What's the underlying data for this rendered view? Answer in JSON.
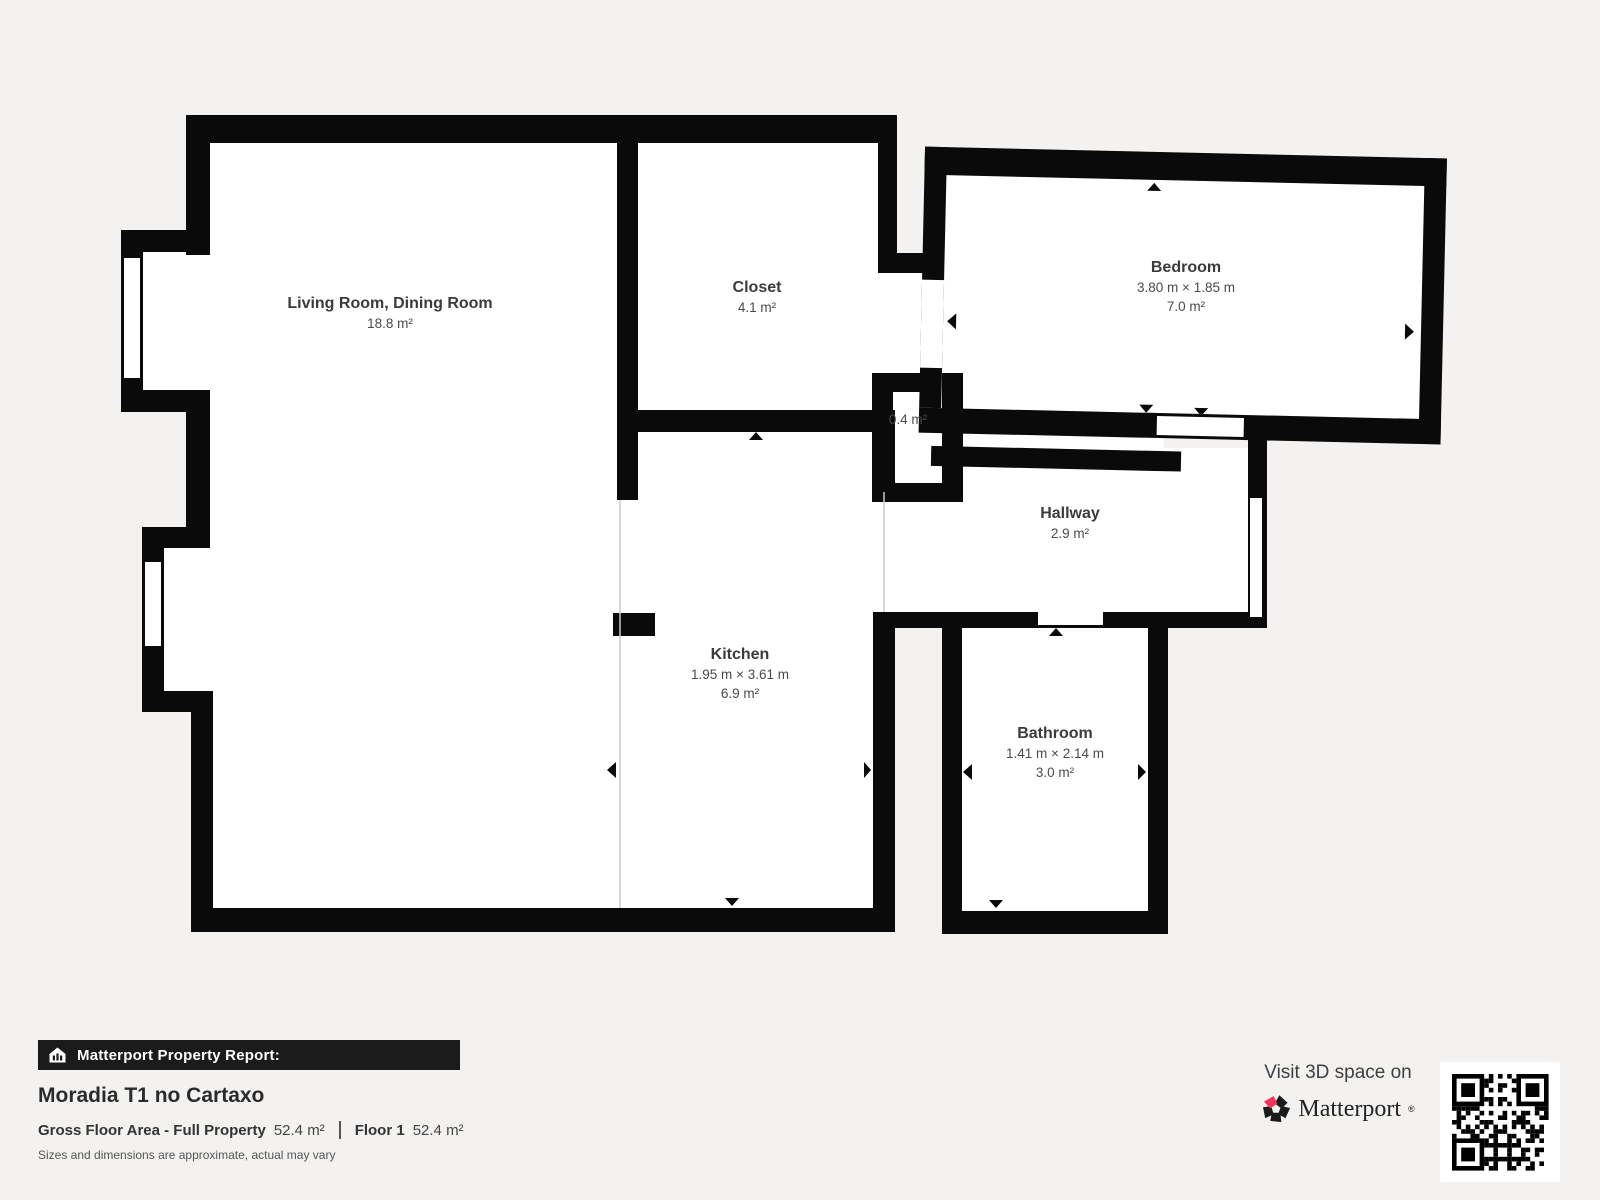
{
  "colors": {
    "background": "#f3f2f0",
    "wall": "#0a0a0a",
    "room_fill": "#ffffff",
    "open_boundary": "#c9c9c9",
    "accent_pink": "#f5325b",
    "badge_bg": "#1b1b1b"
  },
  "floorplan": {
    "rooms": [
      {
        "name": "Living Room, Dining Room",
        "dims": "",
        "area": "18.8 m²"
      },
      {
        "name": "Closet",
        "dims": "",
        "area": "4.1 m²"
      },
      {
        "name": "Bedroom",
        "dims": "3.80 m × 1.85 m",
        "area": "7.0 m²"
      },
      {
        "name": "",
        "dims": "",
        "area": "0.4 m²"
      },
      {
        "name": "Hallway",
        "dims": "",
        "area": "2.9 m²"
      },
      {
        "name": "Kitchen",
        "dims": "1.95 m × 3.61 m",
        "area": "6.9 m²"
      },
      {
        "name": "Bathroom",
        "dims": "1.41 m × 2.14 m",
        "area": "3.0 m²"
      }
    ]
  },
  "report": {
    "badge": "Matterport Property Report:",
    "property_name": "Moradia T1 no Cartaxo",
    "gross_floor_area_label": "Gross Floor Area - Full Property",
    "gross_floor_area_value": "52.4 m²",
    "floor_label": "Floor 1",
    "floor_value": "52.4 m²",
    "disclaimer": "Sizes and dimensions are approximate, actual may vary"
  },
  "promo": {
    "visit_text": "Visit 3D space on",
    "brand": "Matterport",
    "brand_mark": "®"
  }
}
